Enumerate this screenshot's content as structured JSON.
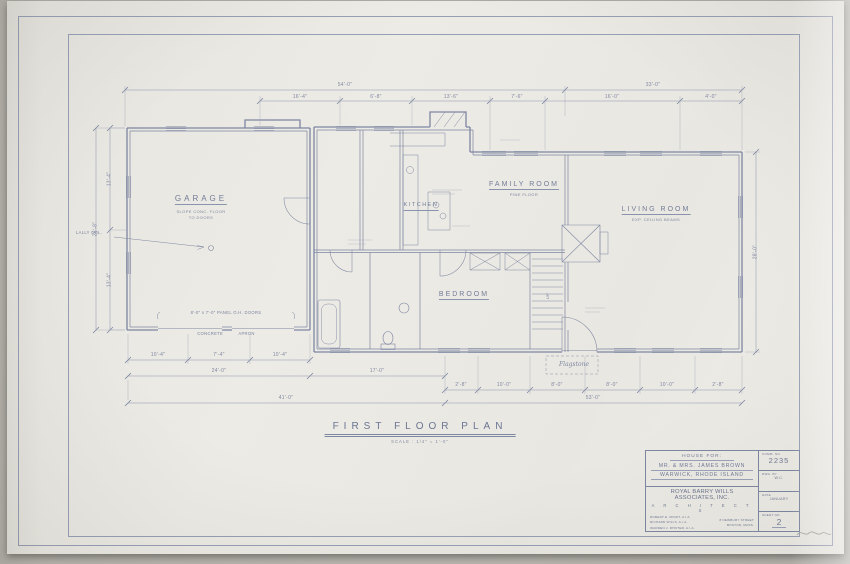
{
  "plan": {
    "rooms": {
      "garage": {
        "label": "GARAGE",
        "sub1": "SLOPE CONC. FLOOR",
        "sub2": "TO DOORS"
      },
      "kitchen": {
        "label": "KITCHEN"
      },
      "family": {
        "label": "FAMILY ROOM",
        "sub1": "PINE FLOOR"
      },
      "living": {
        "label": "LIVING ROOM",
        "sub1": "EXP. CEILING BEAMS"
      },
      "bedroom": {
        "label": "BEDROOM"
      },
      "stair": {
        "label": "UP"
      }
    },
    "notes": {
      "lally": "LALLY COL.",
      "garage_doors": "8'-0\" x 7'-0\" PANEL O.H. DOORS",
      "apron": "CONCRETE APRON",
      "flagstone": "Flagstone"
    },
    "dims": {
      "top1": [
        "54'-0\"",
        "33'-0\""
      ],
      "top2": [
        "16'-4\"",
        "6'-8\"",
        "13'-6\"",
        "7'-6\"",
        "16'-0\"",
        "4'-0\""
      ],
      "bottom1": [
        "10'-4\"",
        "7'-4\"",
        "10'-4\""
      ],
      "bottom2": [
        "24'-0\"",
        "17'-0\""
      ],
      "bottom3": [
        "2'-8\"",
        "10'-0\"",
        "8'-0\"",
        "8'-0\"",
        "10'-0\"",
        "2'-8\""
      ],
      "bottom4": [
        "41'-0\"",
        "53'-0\""
      ],
      "left": [
        "13'-4\"",
        "13'-4\"",
        "26'-8\""
      ],
      "right": [
        "28'-0\""
      ]
    },
    "title": "FIRST FLOOR PLAN",
    "title_scale": "SCALE : 1/4\" = 1'-0\""
  },
  "title_block": {
    "project_label": "HOUSE FOR:",
    "client": "MR. & MRS. JAMES BROWN",
    "location": "WARWICK, RHODE ISLAND",
    "firm": "ROYAL BARRY WILLS ASSOCIATES, INC.",
    "firm_sub": "A R C H I T E C T S",
    "principal1": "ROBERT E. MINOT, A.I.A.",
    "principal2": "RICHARD WILLS, A.I.A.",
    "principal3": "WARREN J. RHOTER, A.I.A.",
    "address1": "8 NEWBURY STREET",
    "address2": "BOSTON, MASS.",
    "comm_label": "COMM. NO.",
    "comm_no": "2235",
    "dwg_label": "DWG. BY",
    "dwg_by": "W.C.",
    "date_label": "DATE",
    "date": "JANUARY",
    "sheet_label": "SHEET NO.",
    "sheet_no": "2"
  }
}
